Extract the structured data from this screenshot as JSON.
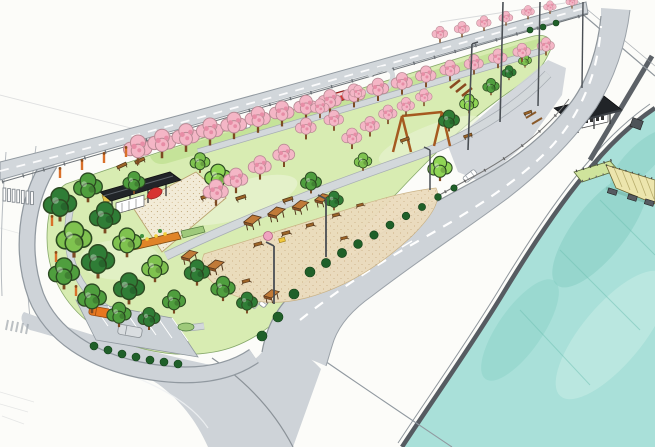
{
  "scene": {
    "description": "Hand-drawn marker and watercolor concept rendering of a long riverside linear park: rows of cherry-blossom trees along a rear road, green lawns and winding paths, a sand plaza with a dark-roofed pavilion and red slide, small orange-roofed picnic shelters and tables, a swing frame, a tree-ringed west end with parking lot and two cars, a curved perimeter road with crosswalk, a main road with dashed lane lines and cars, tall light masts, a white promenade, a dark seawall, a timber pier and teal river water in the lower right, and a flat dark-roofed boat shelter on the wharf."
  },
  "colors": {
    "paper": "#fcfcf9",
    "sketch": "#c9cccf",
    "road": "#ced3d8",
    "road_edge": "#9199a0",
    "marking": "#ffffff",
    "guardrail": "#6d7378",
    "lawn": "#d8ecb2",
    "lawn_bank": "#c3e296",
    "lawn_light": "#e9f4d3",
    "path": "#d3d8db",
    "path_edge": "#a8aeb4",
    "sand": "#f2ebd7",
    "dirt": "#ecdcbd",
    "hedge": "#1f6029",
    "tree_dark": "#2f7d36",
    "tree_mid": "#4f9e3e",
    "tree_light": "#7fc24f",
    "tree_bright": "#8fd455",
    "cherry": "#f4b6c6",
    "cherry_shade": "#e78da6",
    "trunk": "#7c4a22",
    "roof_dark": "#212428",
    "shelter_roof": "#c07a38",
    "shelter_side": "#8a5226",
    "wood": "#8a5a2b",
    "bench": "#9c6428",
    "accent_red": "#d63331",
    "car_orange": "#e8771f",
    "car_silver": "#d9dde0",
    "lamp_orange": "#d9702a",
    "water": "#a9e0d9",
    "water_deep": "#7fcabf",
    "water_pale": "#c9ede6",
    "seawall": "#565b61",
    "berm": "#5c6167",
    "pier_deck": "#ece5ad",
    "pier_ramp": "#cfe39c",
    "pier_dark": "#565b61"
  }
}
